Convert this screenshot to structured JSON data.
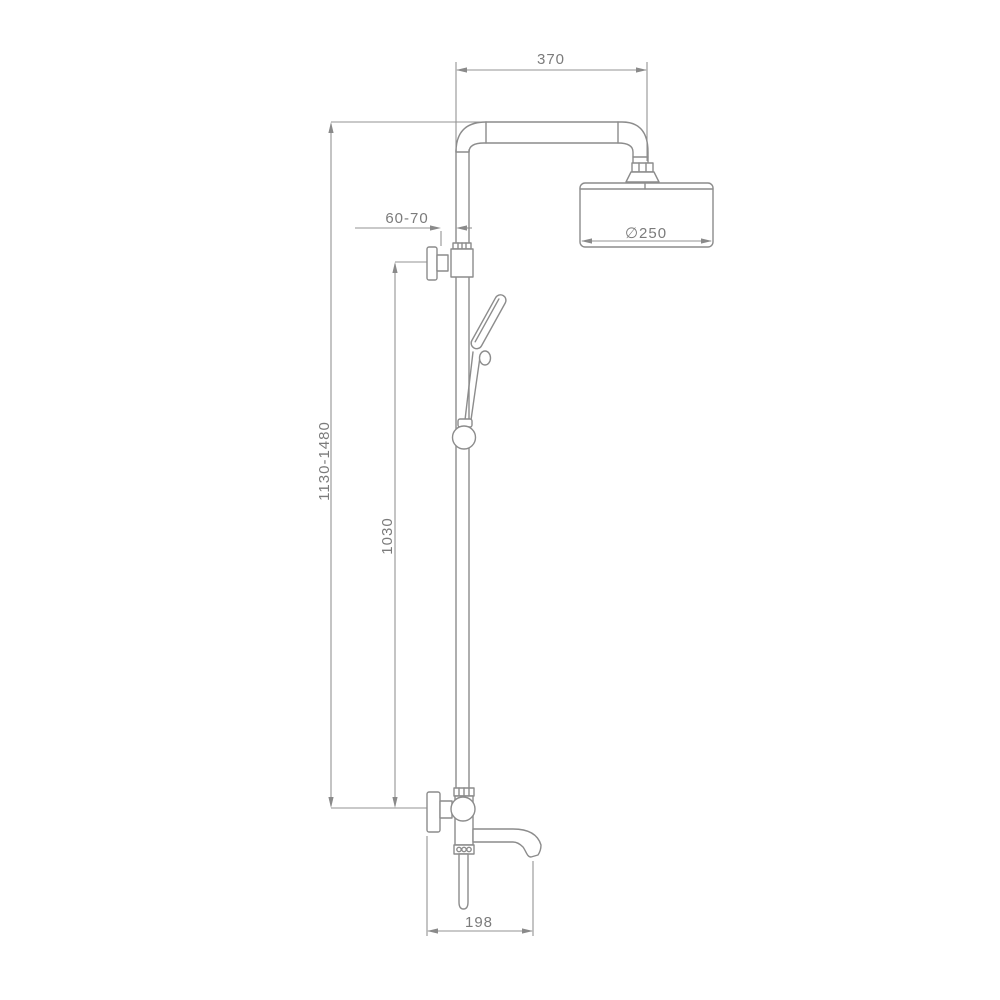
{
  "drawing": {
    "kind": "technical-dimension-drawing",
    "colors": {
      "line": "#8c8c8c",
      "text": "#7b7b7b",
      "background": "#ffffff"
    },
    "dimensions": {
      "arm_length": "370",
      "head_diameter": "∅250",
      "wall_offset": "60-70",
      "column_height": "1130-1480",
      "riser_height": "1030",
      "spout_reach": "198"
    }
  }
}
